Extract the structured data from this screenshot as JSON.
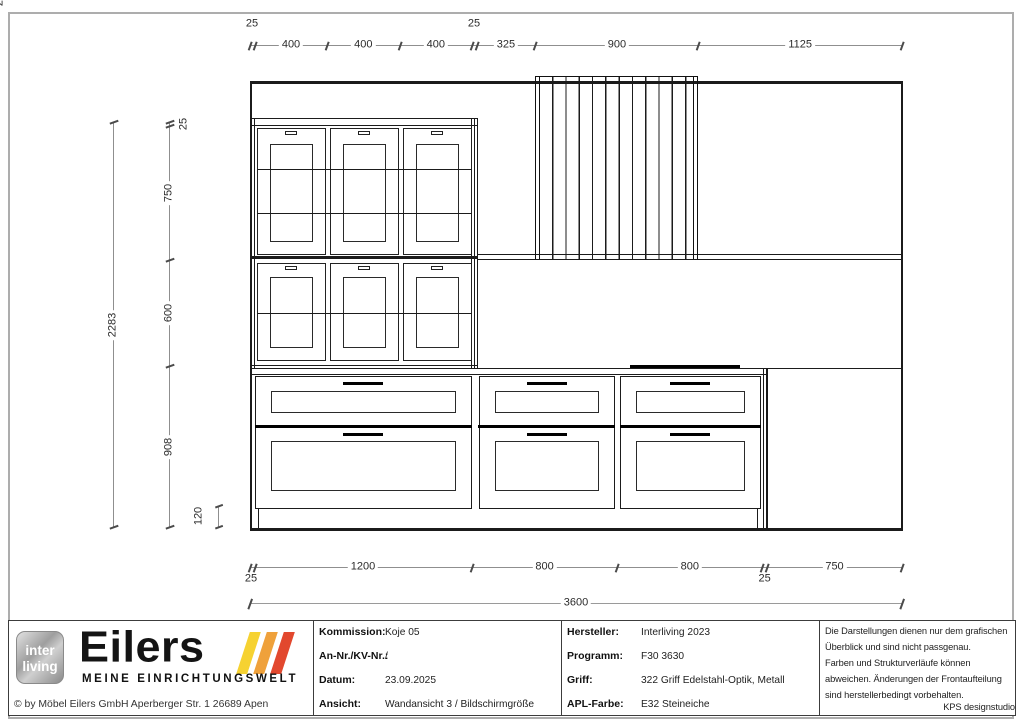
{
  "document": {
    "kind": "kitchen wall elevation drawing",
    "colors": {
      "line": "#1b1b1b",
      "dim_line": "#8f8f8f",
      "dim_text": "#2b2b2b",
      "page_border": "#adadad",
      "slash_yellow": "#f6d231",
      "slash_orange": "#efa13b",
      "slash_red": "#e2482e"
    }
  },
  "dims": {
    "top": [
      "25",
      "400",
      "400",
      "400",
      "25",
      "325",
      "900",
      "1125"
    ],
    "left": {
      "total": "2283",
      "segments": [
        "25",
        "750",
        "600",
        "908"
      ],
      "plinth": "120"
    },
    "bottom": {
      "segments": [
        "25",
        "1200",
        "800",
        "800",
        "25",
        "750"
      ],
      "total": "3600"
    }
  },
  "titleblock": {
    "brand": {
      "badge_top": "inter",
      "badge_bottom": "living",
      "name": "Eilers",
      "tagline": "MEINE EINRICHTUNGSWELT",
      "copyright": "© by Möbel Eilers GmbH Aperberger Str. 1 26689 Apen"
    },
    "info_left": [
      {
        "label": "Kommission:",
        "value": "Koje 05"
      },
      {
        "label": "An-Nr./KV-Nr.:",
        "value": "/"
      },
      {
        "label": "Datum:",
        "value": "23.09.2025"
      },
      {
        "label": "Ansicht:",
        "value": "Wandansicht 3 / Bildschirmgröße"
      }
    ],
    "info_right": [
      {
        "label": "Hersteller:",
        "value": "Interliving 2023"
      },
      {
        "label": "Programm:",
        "value": "F30 3630"
      },
      {
        "label": "Griff:",
        "value": "322 Griff Edelstahl-Optik, Metall"
      },
      {
        "label": "APL-Farbe:",
        "value": "E32 Steineiche"
      }
    ],
    "disclaimer": [
      "Die Darstellungen dienen nur dem grafischen",
      "Überblick und sind nicht passgenau.",
      "Farben und Strukturverläufe können",
      "abweichen. Änderungen der Frontaufteilung",
      "sind herstellerbedingt vorbehalten."
    ],
    "studio": "KPS designstudio"
  }
}
